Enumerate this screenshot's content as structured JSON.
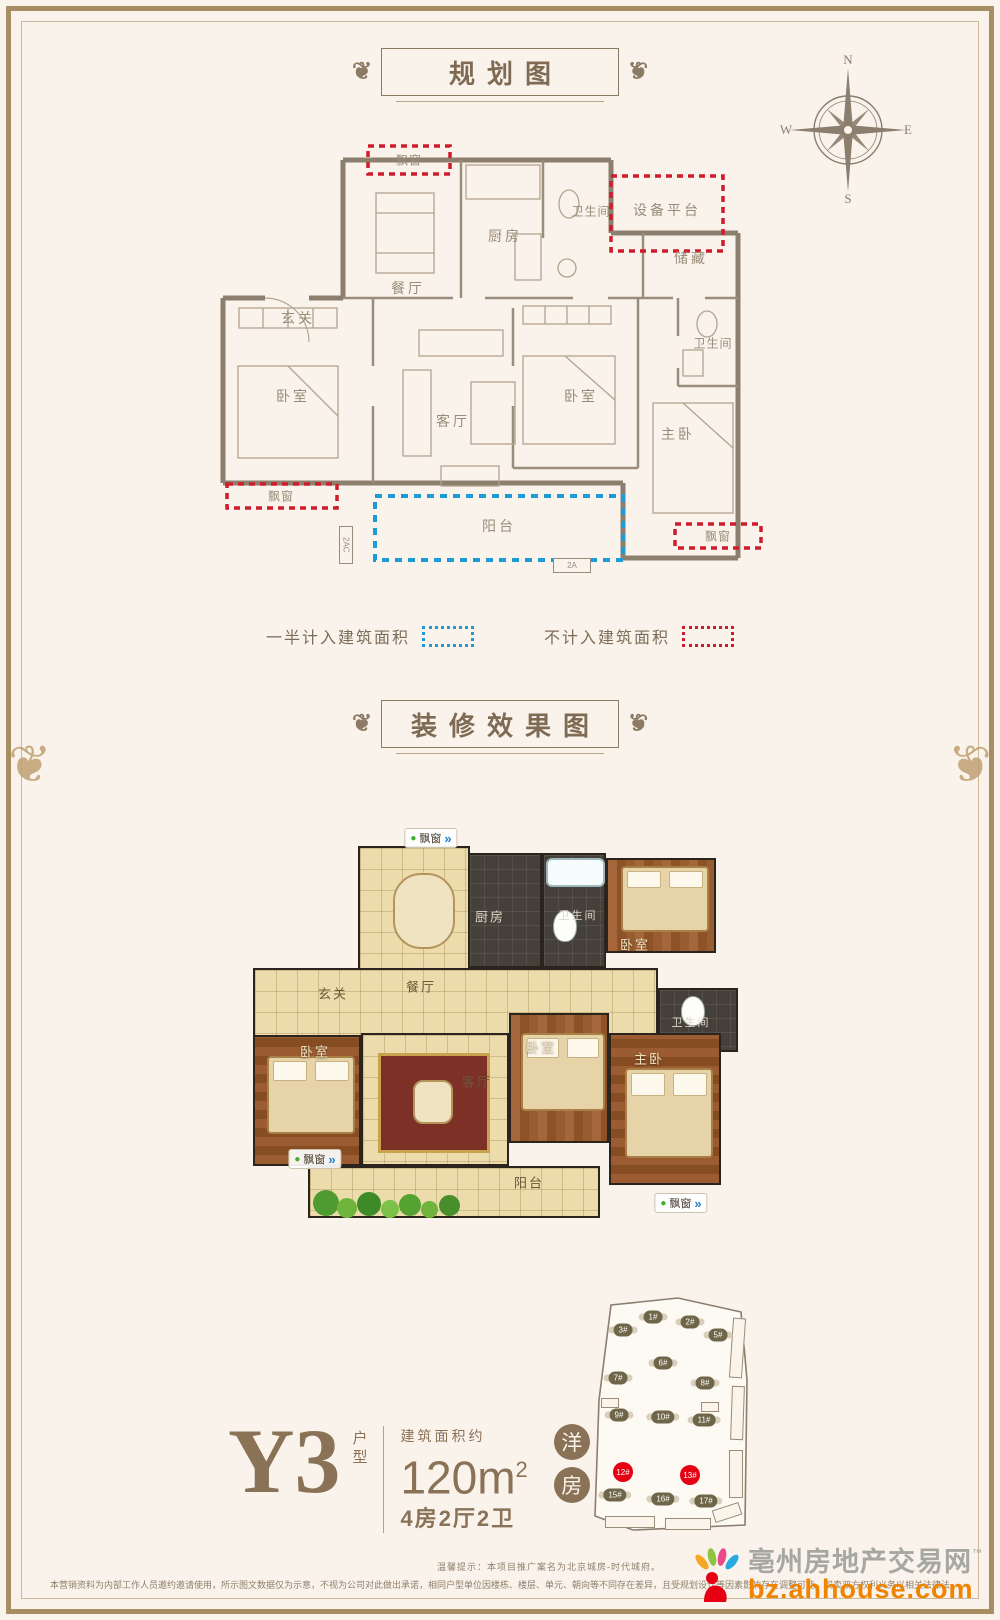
{
  "titles": {
    "plan": "规划图",
    "render": "装修效果图"
  },
  "icons": {
    "flourish": "❦",
    "bullet": "●",
    "arrow": "»"
  },
  "compass": {
    "n": "N",
    "e": "E",
    "s": "S",
    "w": "W"
  },
  "rooms": {
    "bay_window": "飘窗",
    "kitchen": "厨房",
    "bathroom": "卫生间",
    "equipment_platform": "设备平台",
    "storage": "储藏",
    "dining": "餐厅",
    "foyer": "玄关",
    "bedroom": "卧室",
    "living": "客厅",
    "master_bedroom": "主卧",
    "balcony": "阳台",
    "ac1": "2AC",
    "ac2": "2A"
  },
  "legend": {
    "half": "一半计入建筑面积",
    "excluded": "不计入建筑面积",
    "half_color": "#1e9bd7",
    "excluded_color": "#cf1b2b"
  },
  "siteplan": {
    "buildings": [
      {
        "label": "1#"
      },
      {
        "label": "2#"
      },
      {
        "label": "3#"
      },
      {
        "label": "5#"
      },
      {
        "label": "6#"
      },
      {
        "label": "7#"
      },
      {
        "label": "8#"
      },
      {
        "label": "9#"
      },
      {
        "label": "10#"
      },
      {
        "label": "11#"
      },
      {
        "label": "12#",
        "highlight": true
      },
      {
        "label": "13#",
        "highlight": true
      },
      {
        "label": "15#"
      },
      {
        "label": "16#"
      },
      {
        "label": "17#"
      }
    ],
    "highlight_color": "#e60013"
  },
  "unit": {
    "code": "Y3",
    "code_suffix": "户型",
    "area_label": "建筑面积约",
    "area_value": "120m",
    "area_sup": "2",
    "rooms_spec": "4房2厅2卫",
    "badge1": "洋",
    "badge2": "房"
  },
  "footer": {
    "notice": "温馨提示：本项目推广案名为北京城房-时代城府。",
    "disclaimer": "本营销资料为内部工作人员邀约邀请使用，所示图文数据仅为示意，不视为公司对此做出承诺，相同户型单位因楼栋、楼层、单元、朝向等不同存在差异，且受规划设计等因素影响存在调整可能，买卖双方权利义务以相关法律法规及双方签订的商品房买卖合同约定为准，敬请知悉。"
  },
  "watermark": {
    "site_name": "亳州房地产交易网",
    "tm": "™",
    "site_url": "bz.ahhouse.com"
  }
}
